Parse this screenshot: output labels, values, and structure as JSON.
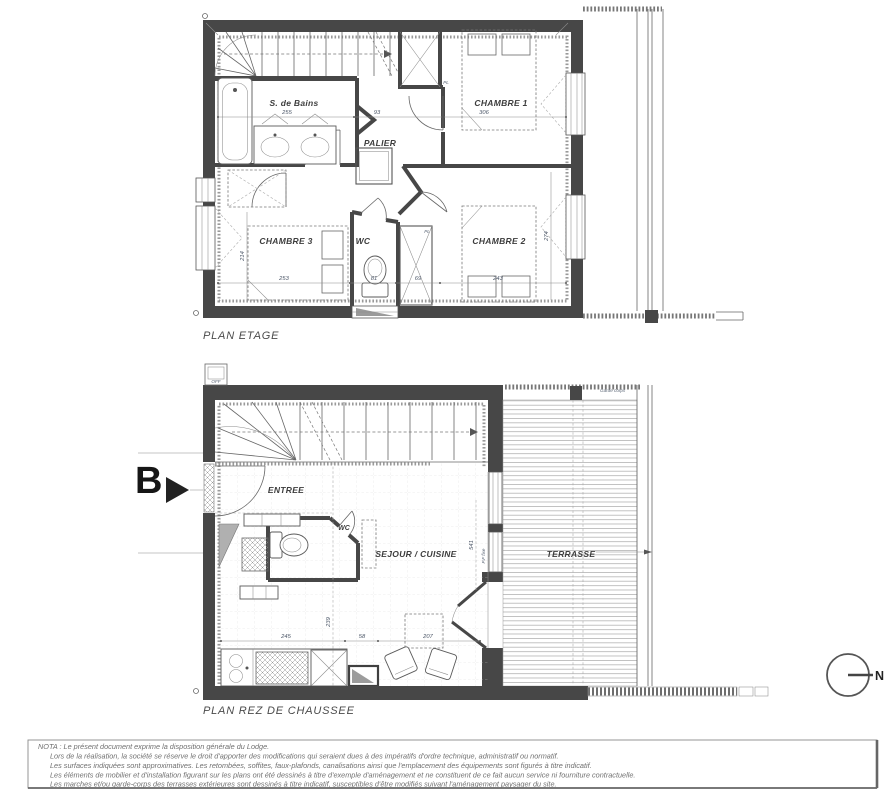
{
  "etage": {
    "title": "PLAN ETAGE",
    "labels": {
      "bath": "S. de Bains",
      "palier": "PALIER",
      "chambre1": "CHAMBRE 1",
      "chambre2": "CHAMBRE 2",
      "chambre3": "CHAMBRE 3",
      "wc": "WC",
      "closet": "PL",
      "closet2": "PL"
    },
    "dims": {
      "bath_w": "255",
      "palier_w": "93",
      "ch1_w": "306",
      "ch3_w": "253",
      "wc_w": "81",
      "pl_w": "69",
      "ch2_w": "243",
      "ch3_h": "214",
      "ch2_h": "274"
    }
  },
  "rdc": {
    "title": "PLAN REZ DE CHAUSSEE",
    "labels": {
      "entree": "ENTREE",
      "wc": "WC",
      "sejour": "SEJOUR / CUISINE",
      "terrasse": "TERRASSE",
      "off": "OFF",
      "garde_corps": "Garde corps",
      "pf_fixe": "P.F fixe"
    },
    "dims": {
      "kitchen_w": "245",
      "mid_w": "58",
      "dining_w": "207",
      "depth": "239",
      "bay_h": "541"
    }
  },
  "marker_b": "B",
  "north_label": "N",
  "nota": {
    "line1": "NOTA : Le présent document exprime la disposition générale du Lodge.",
    "line2": "Lors de la réalisation, la société se réserve le droit d'apporter des modifications qui seraient dues à des impératifs d'ordre technique, administratif ou normatif.",
    "line3": "Les surfaces indiquées sont approximatives. Les retombées, soffites, faux-plafonds, canalisations ainsi que l'emplacement des équipements sont figurés à titre indicatif.",
    "line4": "Les éléments de mobilier et d'installation figurant sur les plans ont été dessinés à titre d'exemple d'aménagement et ne constituent de ce fait aucun service ni fourniture contractuelle.",
    "line5": "Les marches et/ou garde-corps des terrasses extérieures sont dessinés à titre indicatif, susceptibles d'être modifiés suivant l'aménagement paysager du site."
  },
  "colors": {
    "wall": "#474747",
    "line": "#666666",
    "nota_text": "#6f6f6f"
  }
}
